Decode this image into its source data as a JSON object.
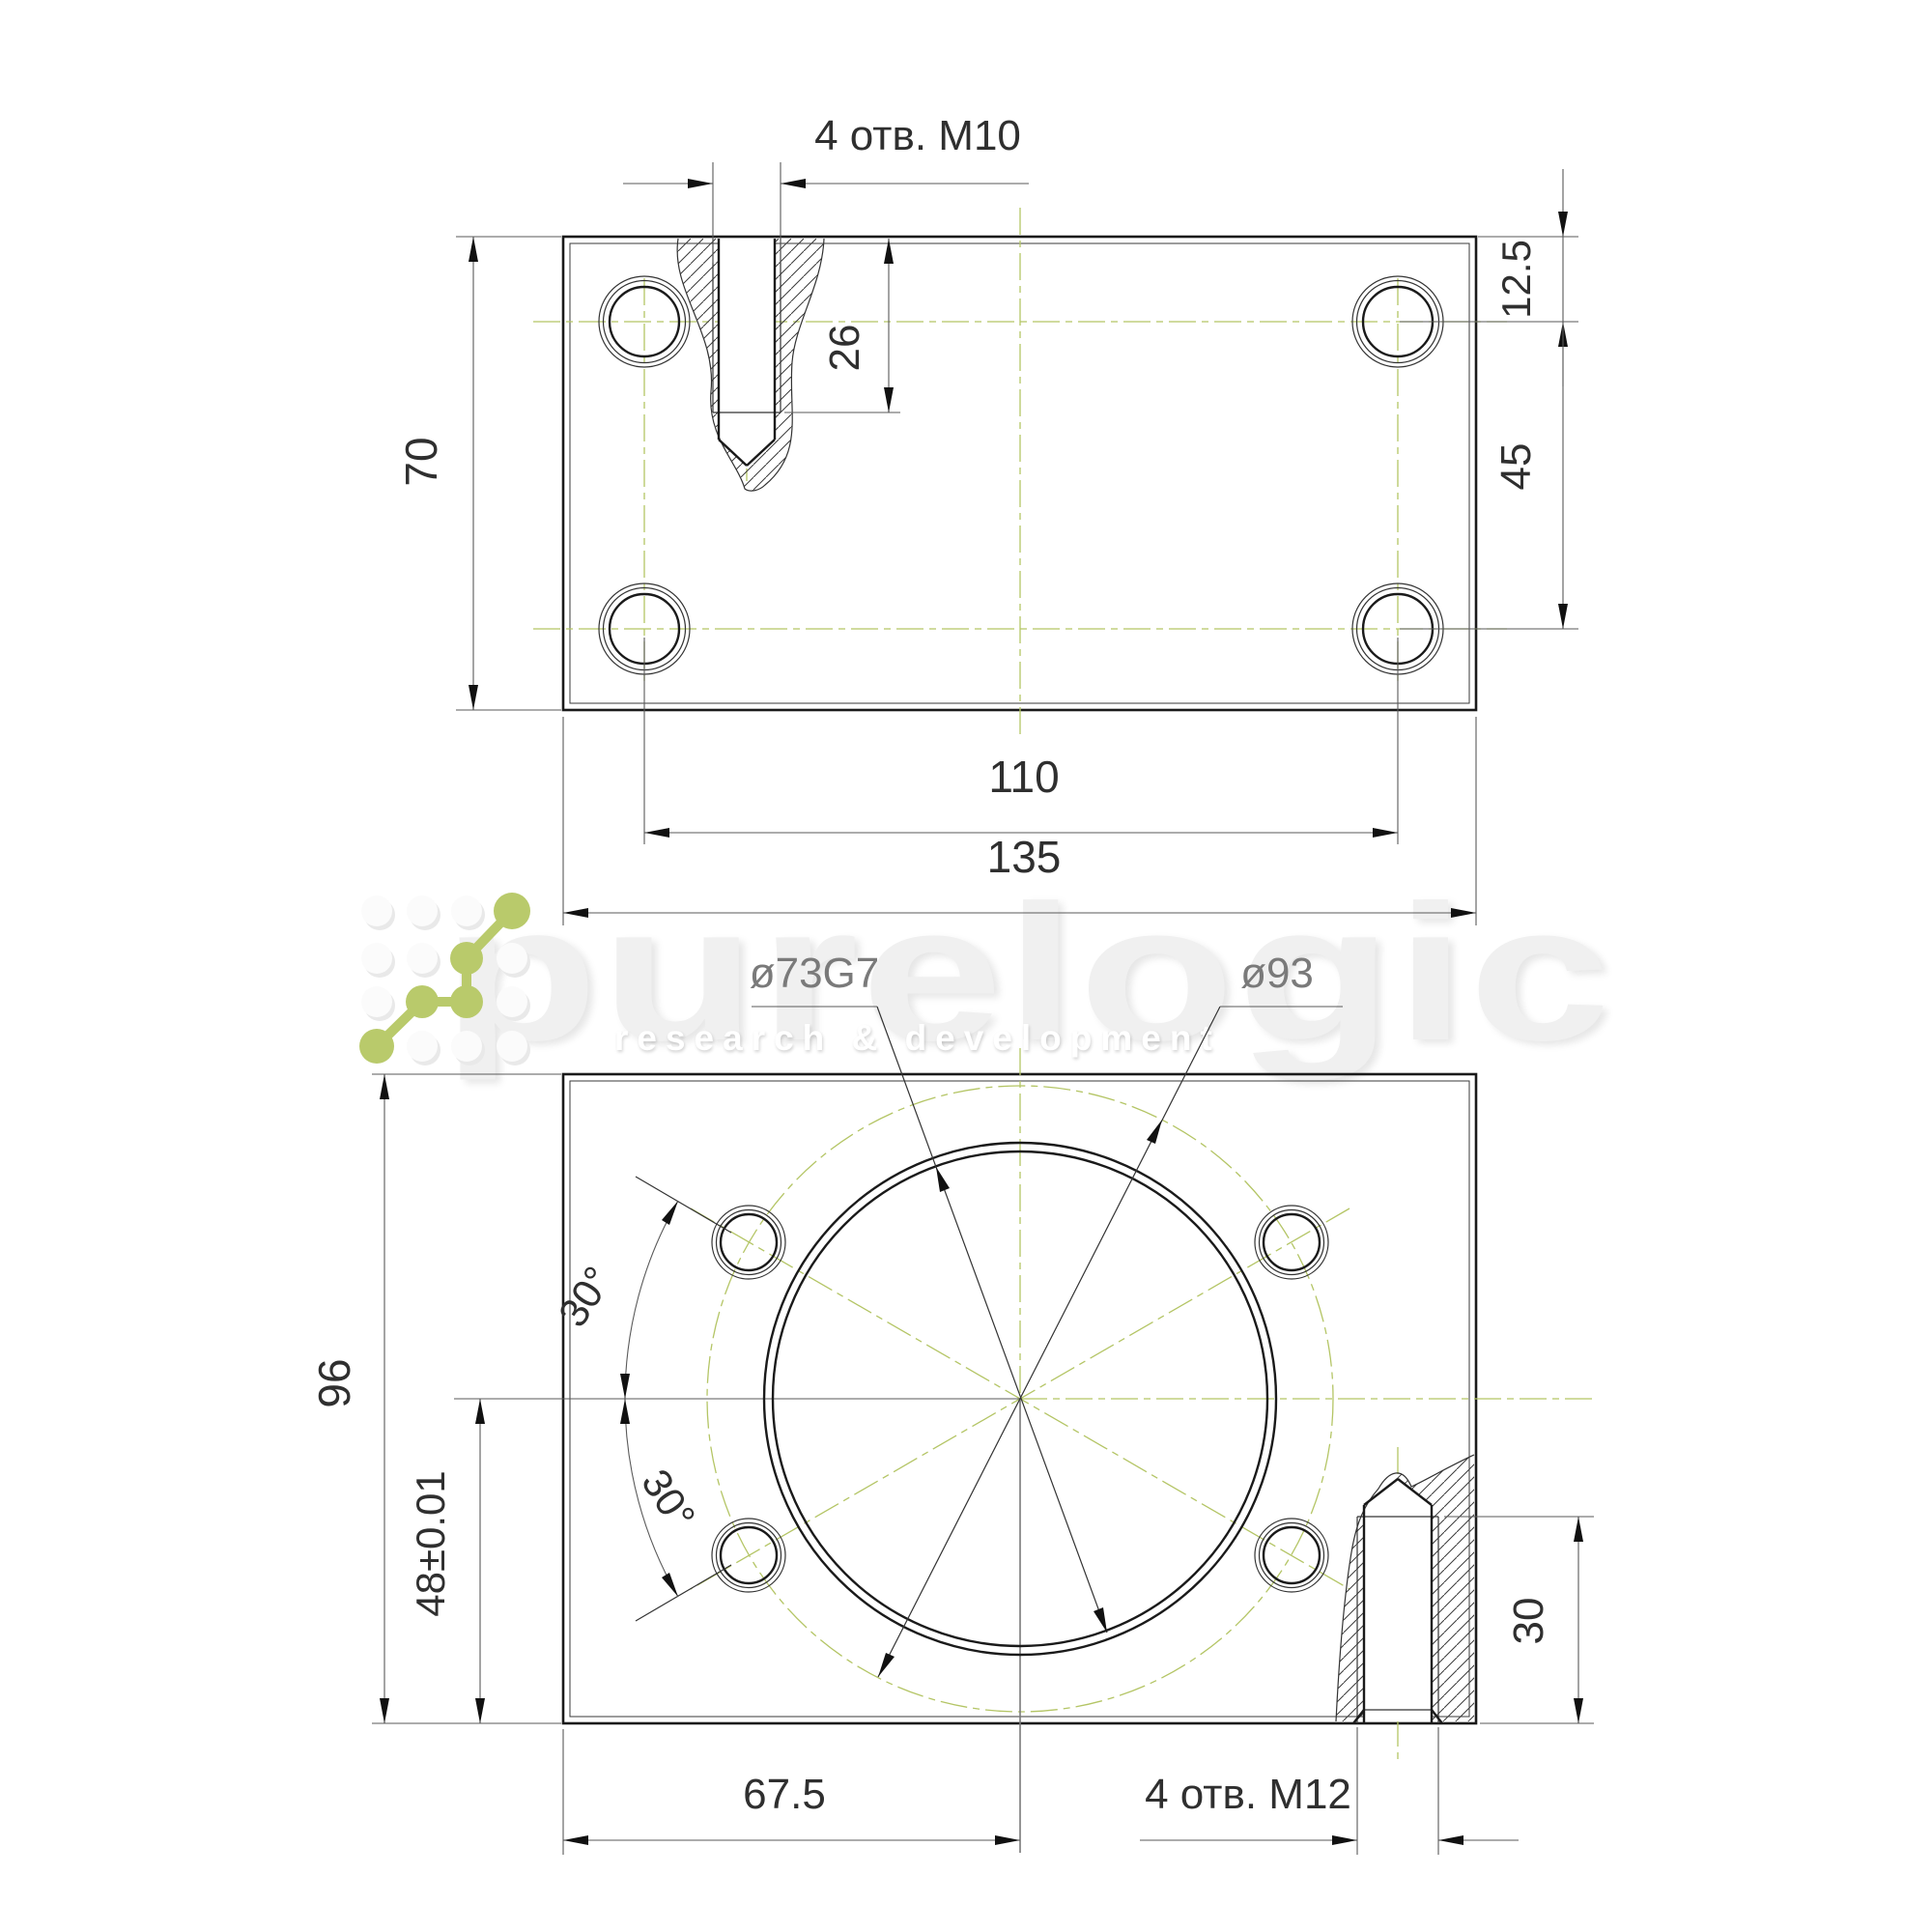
{
  "watermark": {
    "brand": "purelogic",
    "tagline": "research & development"
  },
  "colors": {
    "outline": "#1a1a1a",
    "centerline_olive": "#b4c565",
    "logo_green": "#b9ca6b",
    "dimension_gray": "#5a5a5a",
    "watermark_gray": "#f0f0f0"
  },
  "top_view": {
    "labels": {
      "holes": "4 отв. М10",
      "thread_depth": "26",
      "height": "70",
      "offset_top": "12.5",
      "row_spacing": "45",
      "hole_spacing": "110",
      "width": "135"
    }
  },
  "bottom_view": {
    "labels": {
      "bore": "ø73G7",
      "bolt_circle": "ø93",
      "height": "96",
      "center_height": "48±0.01",
      "angle_upper": "30°",
      "angle_lower": "30°",
      "center_offset": "67.5",
      "holes": "4 отв. М12",
      "thread_depth": "30"
    }
  }
}
